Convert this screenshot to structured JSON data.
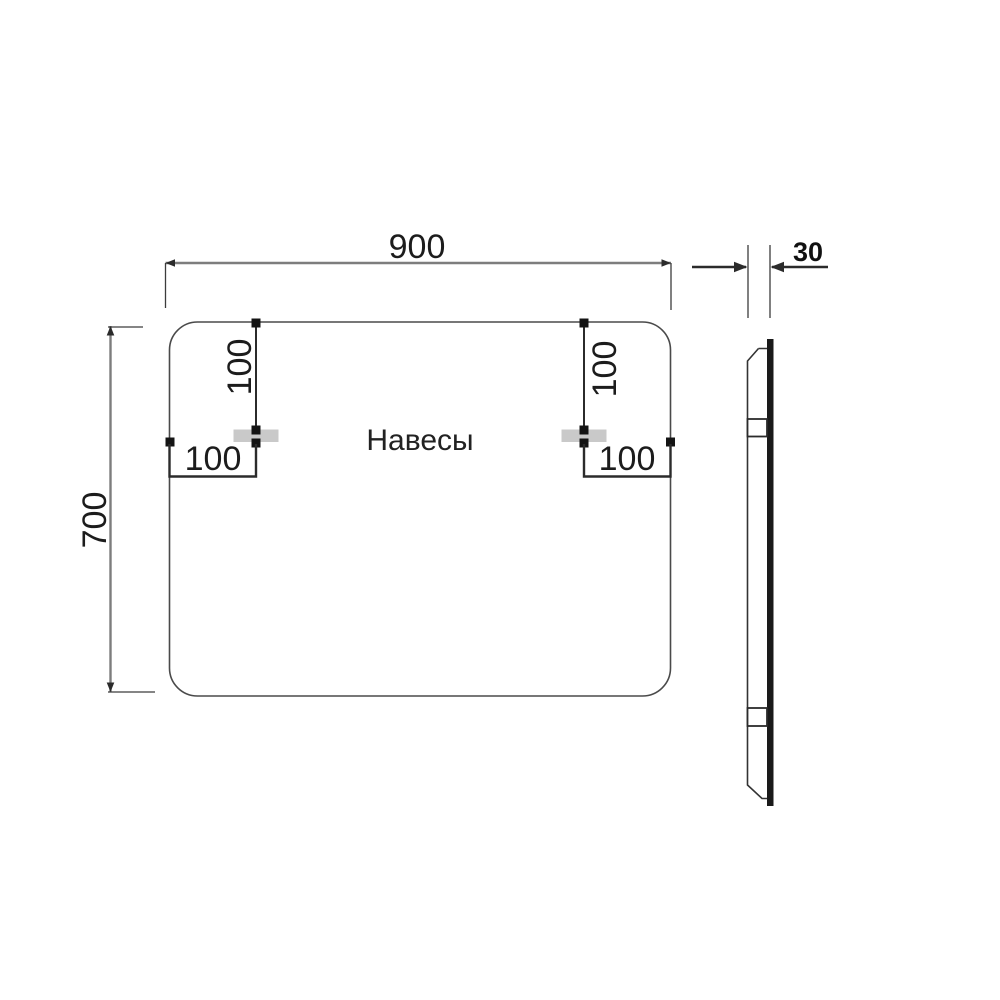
{
  "front_view": {
    "width_dim": "900",
    "height_dim": "700",
    "hangers_label": "Навесы",
    "left_hanger": {
      "top_offset_dim": "100",
      "side_offset_dim": "100"
    },
    "right_hanger": {
      "top_offset_dim": "100",
      "side_offset_dim": "100"
    }
  },
  "side_view": {
    "depth_dim": "30"
  },
  "colors": {
    "outline": "#4a4a4a",
    "dimension_line": "#7d7d7d",
    "marker": "#141414",
    "hanger_fill": "#c9c9c9",
    "profile_back": "#1a1a1a",
    "text": "#1c1c1c",
    "background": "#ffffff"
  }
}
